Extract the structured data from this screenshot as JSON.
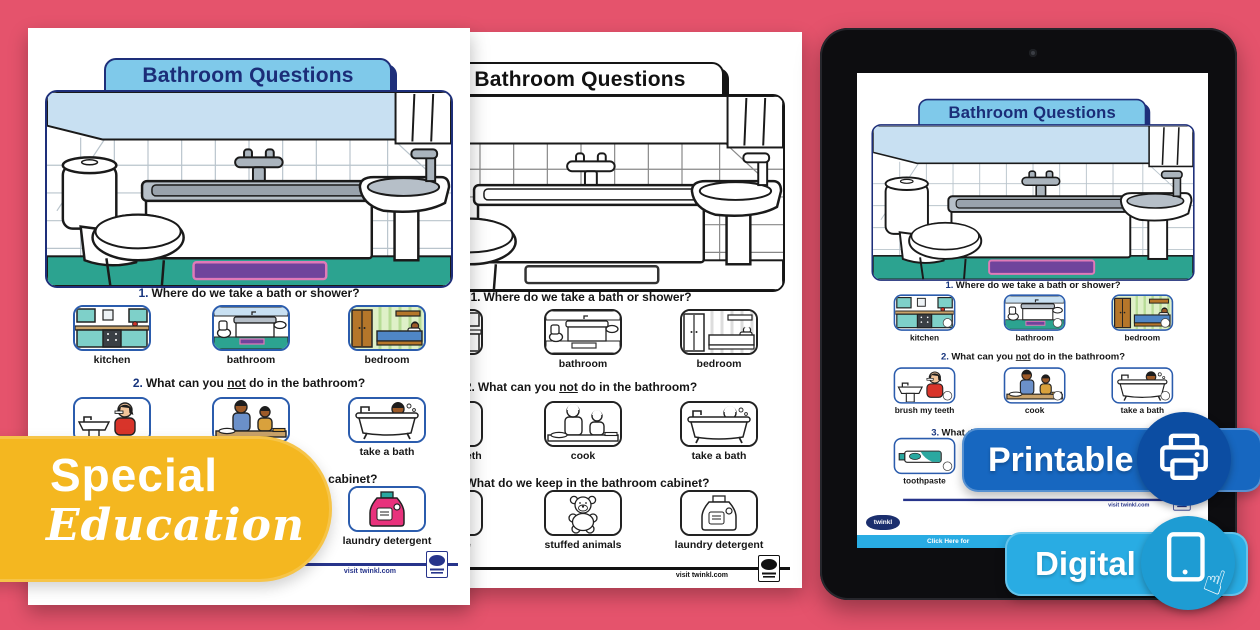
{
  "worksheet": {
    "title": "Bathroom Questions",
    "questions": [
      {
        "num": "1.",
        "pre": "Where do we take a bath or shower?",
        "options": [
          "kitchen",
          "bathroom",
          "bedroom"
        ]
      },
      {
        "num": "2.",
        "pre": "What can you ",
        "underline": "not",
        "post": " do in the bathroom?",
        "options": [
          "brush my teeth",
          "cook",
          "take a bath"
        ]
      },
      {
        "num": "3.",
        "pre": "What do we keep in the bathroom cabinet?",
        "options": [
          "toothpaste",
          "stuffed animals",
          "laundry detergent"
        ]
      }
    ],
    "footer_link": "visit twinkl.com"
  },
  "brand": {
    "name": "twinkl"
  },
  "tablet": {
    "bottom_bar_text": "Click Here for"
  },
  "badges": {
    "printable_label": "Printable",
    "digital_label": "Digital",
    "special_line1": "Special",
    "special_line2": "Education"
  },
  "icons": {
    "printer": "printer-icon",
    "tablet_touch": "tablet-touch-icon",
    "pointing_hand": "☝",
    "camera": "camera-dot"
  },
  "colors": {
    "bg": "#e5536c",
    "yellow": "#f4b720",
    "printable": "#1767c0",
    "printablec": "#0c4da2",
    "digital": "#29ace3",
    "digitalc": "#1e9cd3",
    "tabletbody": "#0d0d10",
    "brandnavy": "#1b2f6e",
    "tab_blue": "#7fc9ea",
    "title_navy": "#1b2d78",
    "floor_teal": "#2ca390",
    "mat_purple": "#6f449c",
    "wall_blue": "#c8e0f2"
  }
}
